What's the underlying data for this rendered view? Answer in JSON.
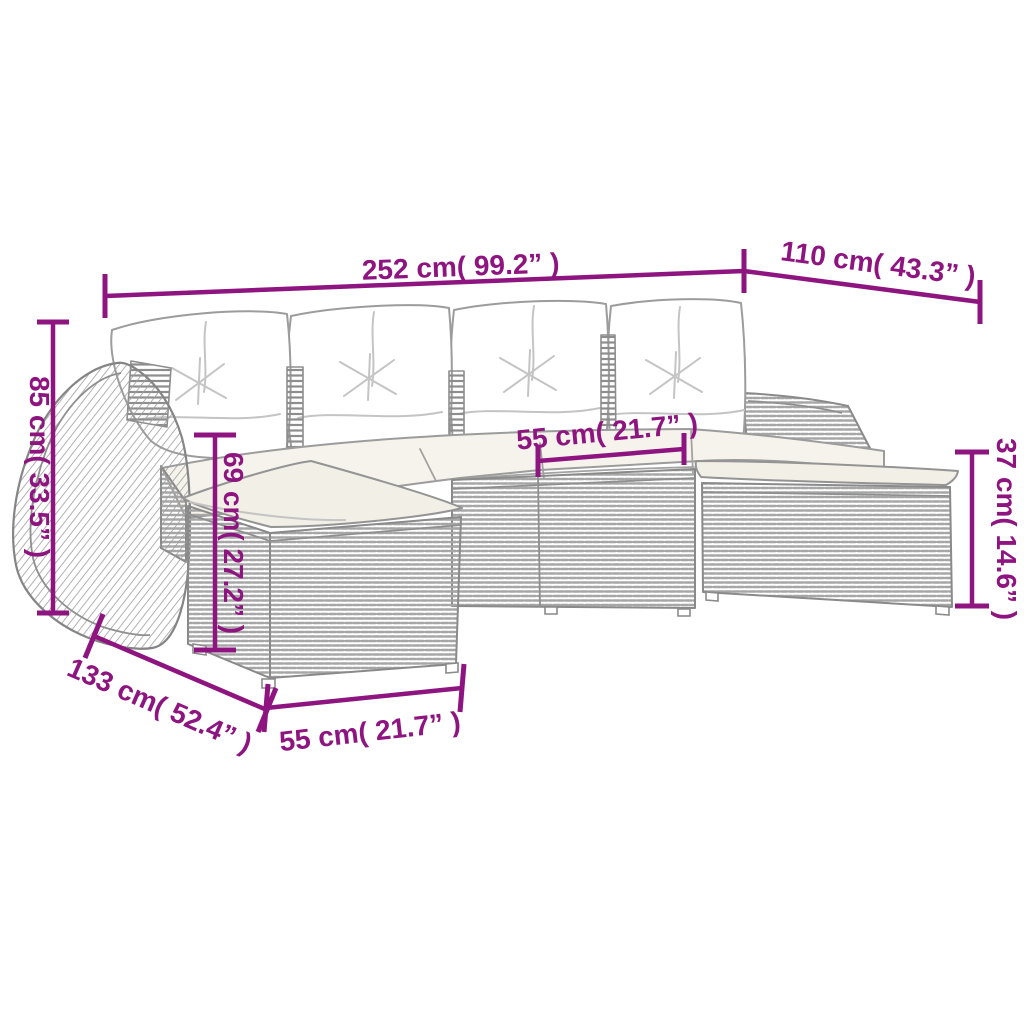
{
  "canvas": {
    "width": 1024,
    "height": 1024,
    "background": "#ffffff"
  },
  "style": {
    "accent_color": "#8E1480",
    "line_art_color": "#8a8a8a",
    "weave_color": "#a6a6a6",
    "cushion_fill": "#f2efe6",
    "pillow_fill": "#ffffff"
  },
  "dimensions": {
    "overall_width": {
      "label": "252 cm( 99.2” )",
      "cm": 252,
      "inches": 99.2
    },
    "right_depth": {
      "label": "110 cm( 43.3” )",
      "cm": 110,
      "inches": 43.3
    },
    "back_height": {
      "label": "85 cm( 33.5” )",
      "cm": 85,
      "inches": 33.5
    },
    "seat_height": {
      "label": "69 cm( 27.2” )",
      "cm": 69,
      "inches": 27.2
    },
    "seat_width": {
      "label": "55 cm( 21.7” )",
      "cm": 55,
      "inches": 21.7
    },
    "ottoman_height": {
      "label": "37 cm( 14.6” )",
      "cm": 37,
      "inches": 14.6
    },
    "left_depth": {
      "label": "133 cm( 52.4” )",
      "cm": 133,
      "inches": 52.4
    },
    "ottoman_width": {
      "label": "55 cm( 21.7” )",
      "cm": 55,
      "inches": 21.7
    }
  }
}
